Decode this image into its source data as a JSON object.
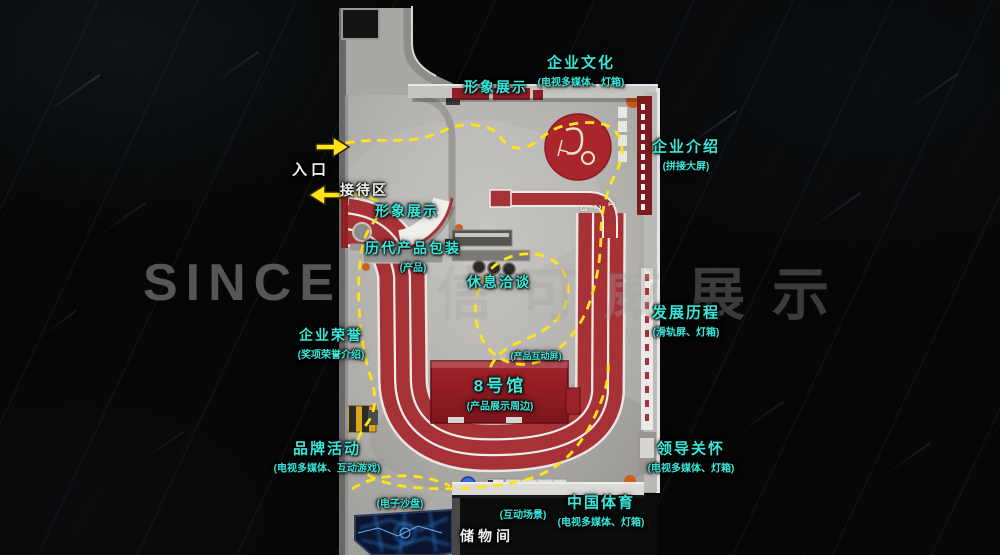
{
  "watermark": {
    "latin": "SINCE",
    "cjk": "信可威展示"
  },
  "entrance": {
    "label": "入口"
  },
  "reception": {
    "label": "接待区"
  },
  "storage": {
    "label": "储物间"
  },
  "zones": {
    "image_top": {
      "title": "形象展示"
    },
    "culture": {
      "title": "企业文化",
      "sub": "(电视多媒体、灯箱)"
    },
    "intro": {
      "title": "企业介绍",
      "sub": "(拼接大屏)"
    },
    "image_left": {
      "title": "形象展示"
    },
    "packaging": {
      "title": "历代产品包装",
      "sub": "(产品)"
    },
    "rest": {
      "title": "休息洽谈"
    },
    "honor": {
      "title": "企业荣誉",
      "sub": "(奖项荣誉介绍)"
    },
    "history": {
      "title": "发展历程",
      "sub": "(滑轨屏、灯箱)"
    },
    "brand": {
      "title": "品牌活动",
      "sub": "(电视多媒体、互动游戏)"
    },
    "care": {
      "title": "领导关怀",
      "sub": "(电视多媒体、灯箱)"
    },
    "sports": {
      "title": "中国体育",
      "sub": "(电视多媒体、灯箱)"
    },
    "sandtable": {
      "title": "(电子沙盘)"
    },
    "interactive": {
      "title": "(互动场景)"
    }
  },
  "booth": {
    "title": "8号馆",
    "sub": "(产品展示周边)",
    "tag": "(产品互动屏)"
  },
  "lanes": [
    "3",
    "2",
    "1"
  ],
  "colors": {
    "accent_cyan": "#38e8da",
    "path_yellow": "#ffe41a",
    "track_red": "#a63238",
    "booth_red": "#96232a",
    "floor_gray": "#b6b4b0"
  }
}
